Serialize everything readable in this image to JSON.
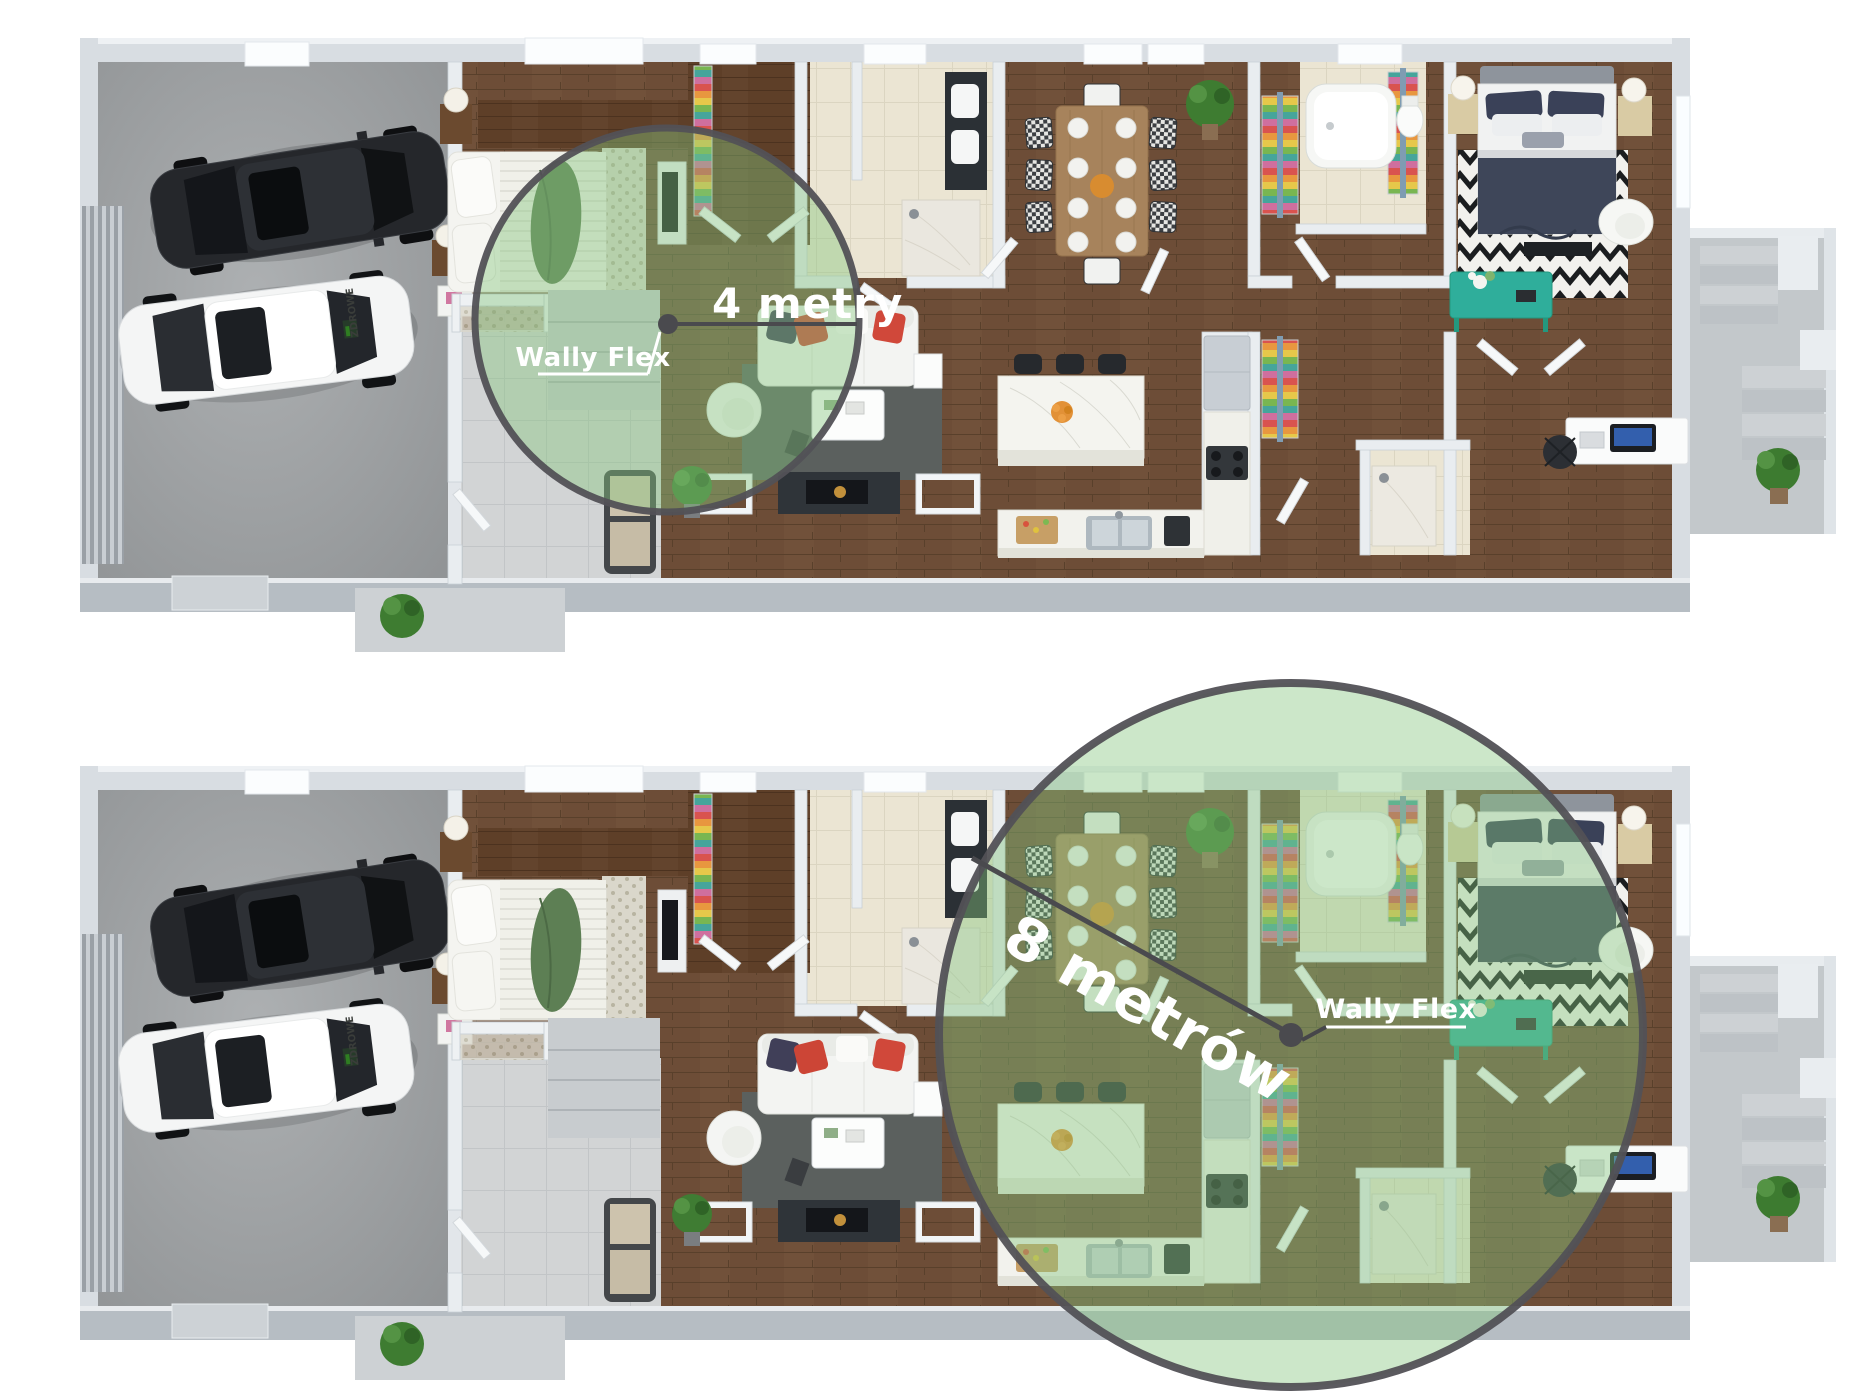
{
  "plans": {
    "top": {
      "range_label": "4 metry",
      "device_label": "Wally Flex",
      "radius_px": 192
    },
    "bottom": {
      "range_label": "8 metrów",
      "device_label": "Wally Flex",
      "radius_px": 352
    }
  },
  "branding": {
    "car_logo_text": "ZDROWE"
  },
  "colors": {
    "coverage_fill": "#86c57e",
    "coverage_border": "#525156",
    "connector": "#4a4a4e",
    "label_color": "#ffffff",
    "accent_teal": "#2fae9b",
    "wood_floor": "#6d4d37",
    "garage_floor": "#a2a5a8"
  }
}
